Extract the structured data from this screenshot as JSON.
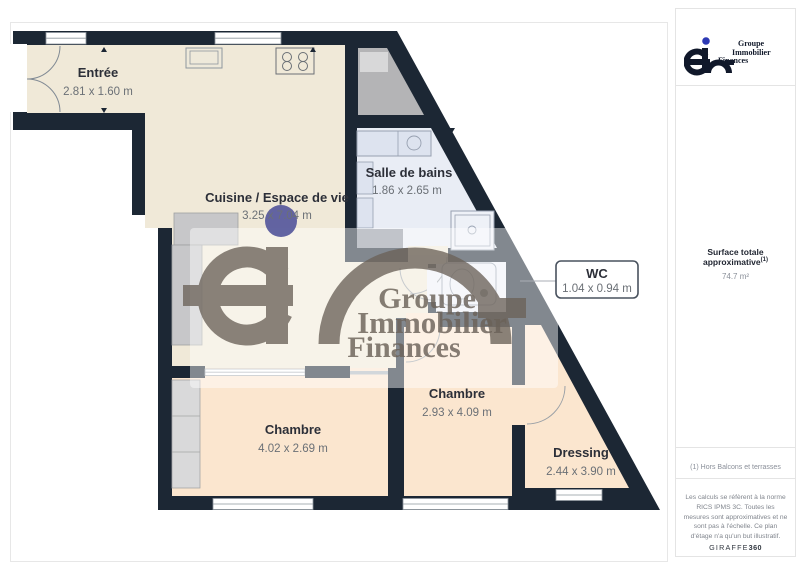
{
  "branding": {
    "name_lines": [
      "Groupe",
      "Immobilier",
      "Finances"
    ]
  },
  "colors": {
    "wall": "#1c2734",
    "floor_main": "#f0e9d8",
    "floor_bedroom": "#fbe6cf",
    "floor_bath": "#e9edf5",
    "closet_gray": "#b4b4b6",
    "watermark_gray": "#6b6259",
    "watermark_dot": "#5a5c9e",
    "logo_dot_blue": "#2d39b4"
  },
  "floorplan": {
    "rooms": [
      {
        "name": "Entrée",
        "dims": "2.81 x 1.60 m"
      },
      {
        "name": "Cuisine / Espace de vie",
        "dims": "3.25 x 7.04 m"
      },
      {
        "name": "Salle de bains",
        "dims": "1.86 x 2.65 m"
      },
      {
        "name": "WC",
        "dims": "1.04 x 0.94 m"
      },
      {
        "name": "Chambre",
        "dims": "2.93 x 4.09 m"
      },
      {
        "name": "Chambre",
        "dims": "4.02 x 2.69 m"
      },
      {
        "name": "Dressing",
        "dims": "2.44 x 3.90 m"
      }
    ]
  },
  "sidebar": {
    "surface_label": "Surface totale approximative",
    "surface_sup": "(1)",
    "surface_value": "74.7 m²",
    "footnote": "(1) Hors Balcons et terrasses",
    "disclaimer": "Les calculs se réfèrent à la norme RICS IPMS 3C. Toutes les mesures sont approximatives et ne sont pas à l'échelle. Ce plan d'étage n'a qu'un but illustratif.",
    "credit_name": "GIRAFFE",
    "credit_suffix": "360"
  }
}
